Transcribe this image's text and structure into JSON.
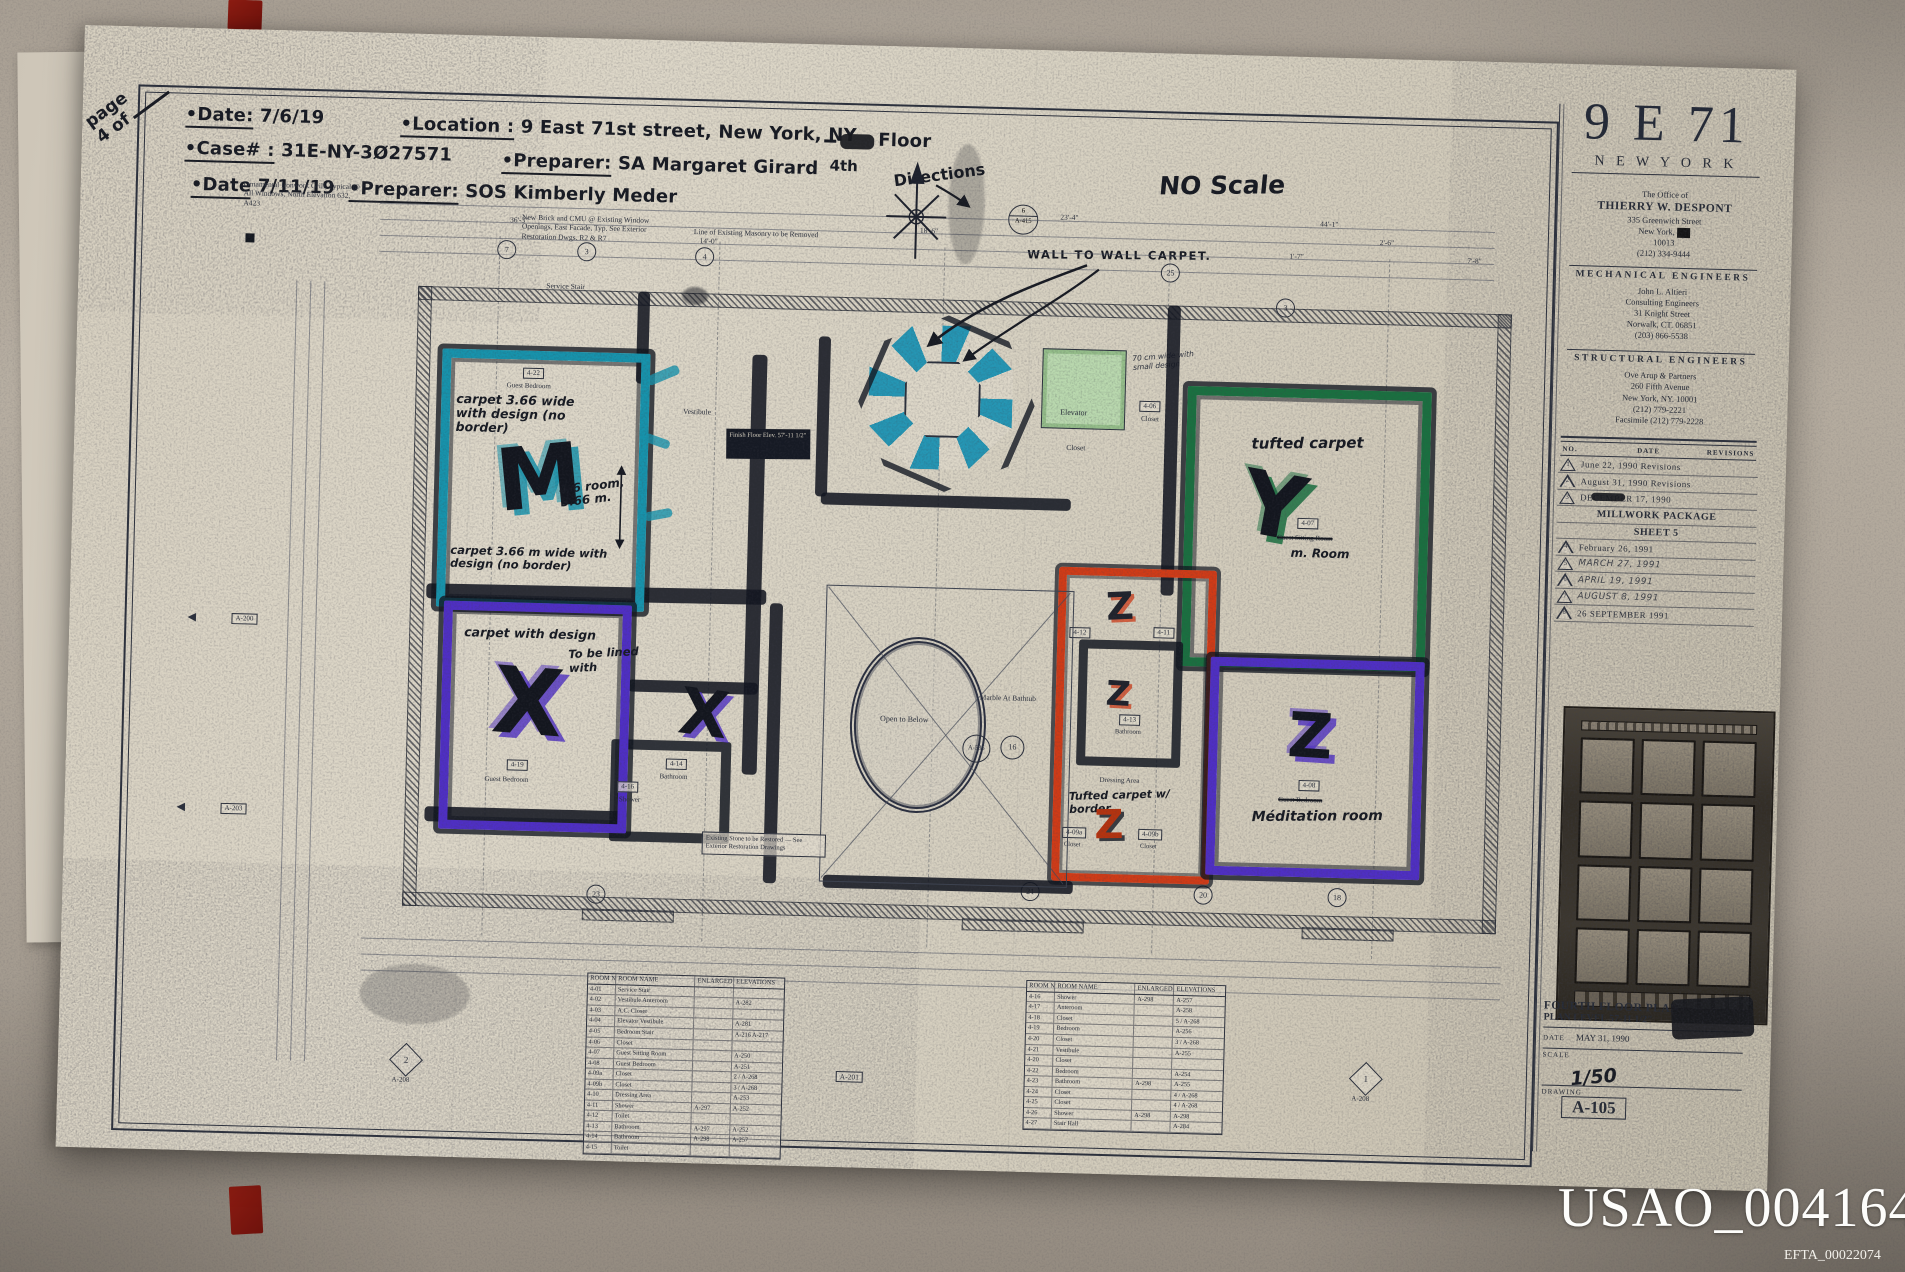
{
  "overlay": {
    "usao": "USAO_004164",
    "efta": "EFTA_00022074"
  },
  "handwritten": {
    "page_word": "page",
    "page_num": "4 of",
    "date1_label": "•Date:",
    "date1": "7/6/19",
    "location_label": "•Location :",
    "location": "9 East 71st street, New York, NY",
    "floor_word": "Floor",
    "floor_sub": "4th",
    "case_label": "•Case# :",
    "case_number": "31E-NY-3Ø27571",
    "preparer1_label": "•Preparer:",
    "preparer1": "SA Margaret Girard",
    "date2_label": "•Date",
    "date2": "7/11/19",
    "preparer2_label": "•Preparer:",
    "preparer2": "SOS Kimberly Meder",
    "directions": "Directions",
    "no_scale": "NO Scale",
    "wall_to_wall": "WALL TO WALL CARPET."
  },
  "plan": {
    "notes": {
      "ornamental": "Ornamental Ironwork Grill, Typical @ All Windows, North Elevation 632, A423",
      "brick": "New Brick and CMU @ Existing Window Openings, East Facade, Typ. See Exterior Restoration Dwgs. R2 & R7",
      "masonry": "Line of Existing Masonry to be Removed",
      "restore": "Existing Stone to be Restored — See Exterior Restoration Drawings",
      "finish_floor": "Finish Floor Elev. 57'-11 1/2\"",
      "seventy_cm": "70 cm wide with small design",
      "to_be_lined": "To be lined with",
      "marble": "Marble At Bathtub",
      "open_below": "Open to Below",
      "service_stair": "Service Stair",
      "vestibule": "Vestibule"
    },
    "rooms": {
      "cyan": {
        "tag": "4-22",
        "name": "Guest Bedroom",
        "letter": "M",
        "note_top": "carpet 3.66 wide with design (no border)",
        "note_mid": "4-6 room, 3.66 m.",
        "note_bottom": "carpet 3.66 m wide with design (no border)"
      },
      "purple": {
        "tag": "4-19",
        "name": "Guest Bedroom",
        "letter": "X",
        "note": "carpet with design"
      },
      "bath": {
        "tag": "4-14",
        "name": "Bathroom",
        "letter": "X"
      },
      "shower": {
        "tag": "4-16",
        "name": "Shower"
      },
      "green": {
        "tag": "4-07",
        "name": "Guest Sitting Room",
        "new_name": "m. Room",
        "letter": "Y",
        "note": "tufted carpet"
      },
      "meditation": {
        "tag": "4-08",
        "name": "Guest Bedroom",
        "new_name": "Méditation room",
        "letter": "Z"
      },
      "red_top": {
        "tag_left": "4-12",
        "tag_right": "4-11",
        "letter": "Z"
      },
      "red_mid": {
        "tag": "4-13",
        "name": "Bathroom",
        "letter": "Z"
      },
      "dressing": {
        "name": "Dressing Area",
        "note": "Tufted carpet w/ border",
        "letter": "Z",
        "closet_a": "4-09a",
        "closet_a_name": "Closet",
        "closet_b": "4-09b",
        "closet_b_name": "Closet"
      },
      "elevator": {
        "name": "Elevator",
        "closet": "Closet",
        "closet_tag": "4-06"
      }
    },
    "tags": {
      "a415_no": "6",
      "a415": "A-415",
      "a535": "A-535",
      "c16": "16",
      "a201": "A-201",
      "d2": "2",
      "d2_ref": "A-208",
      "d1": "1",
      "d1_ref": "A-208",
      "a200": "A-200",
      "a203": "A-203"
    },
    "bubbles": [
      "7",
      "3",
      "4",
      "25",
      "3",
      "23",
      "21",
      "20",
      "18"
    ],
    "dims": [
      "44'-1\"",
      "18'-6\"",
      "14'-0\"",
      "2'-6\"",
      "1'-7\"",
      "7'-8\"",
      "36'-3\"",
      "23'-4\""
    ]
  },
  "tables": {
    "headers": [
      "ROOM NO.",
      "ROOM NAME",
      "ENLARGED PLAN",
      "ELEVATIONS"
    ],
    "left": [
      [
        "4-01",
        "Service Stair",
        "",
        ""
      ],
      [
        "4-02",
        "Vestibule Anteroom",
        "",
        "A-282"
      ],
      [
        "4-03",
        "A.C. Closet",
        "",
        ""
      ],
      [
        "4-04",
        "Elevator Vestibule",
        "",
        "A-281"
      ],
      [
        "4-05",
        "Bedroom Stair",
        "",
        "A-216  A-217"
      ],
      [
        "4-06",
        "Closet",
        "",
        ""
      ],
      [
        "4-07",
        "Guest Sitting Room",
        "",
        "A-250"
      ],
      [
        "4-08",
        "Guest Bedroom",
        "",
        "A-251"
      ],
      [
        "4-09a",
        "Closet",
        "",
        "2 / A-268"
      ],
      [
        "4-09b",
        "Closet",
        "",
        "3 / A-268"
      ],
      [
        "4-10",
        "Dressing Area",
        "",
        "A-253"
      ],
      [
        "4-11",
        "Shower",
        "A-297",
        "A-252"
      ],
      [
        "4-12",
        "Toilet",
        "",
        ""
      ],
      [
        "4-13",
        "Bathroom",
        "A-297",
        "A-252"
      ],
      [
        "4-14",
        "Bathroom",
        "A-298",
        "A-257"
      ],
      [
        "4-15",
        "Toilet",
        "",
        ""
      ]
    ],
    "right": [
      [
        "4-16",
        "Shower",
        "A-298",
        "A-257"
      ],
      [
        "4-17",
        "Anteroom",
        "",
        "A-258"
      ],
      [
        "4-18",
        "Closet",
        "",
        "5 / A-268"
      ],
      [
        "4-19",
        "Bedroom",
        "",
        "A-256"
      ],
      [
        "4-20",
        "Closet",
        "",
        "3 / A-268"
      ],
      [
        "4-21",
        "Vestibule",
        "",
        "A-255"
      ],
      [
        "4-20",
        "Closet",
        "",
        ""
      ],
      [
        "4-22",
        "Bedroom",
        "",
        "A-254"
      ],
      [
        "4-23",
        "Bathroom",
        "A-298",
        "A-255"
      ],
      [
        "4-24",
        "Closet",
        "",
        "4 / A-268"
      ],
      [
        "4-25",
        "Closet",
        "",
        "4 / A-268"
      ],
      [
        "4-26",
        "Shower",
        "A-298",
        "A-298"
      ],
      [
        "4-27",
        "Stair Hall",
        "",
        "A-284"
      ]
    ]
  },
  "titleblock": {
    "big": "9 E 71",
    "city": "N E W   Y O R K",
    "office": [
      "The Office of",
      "THIERRY W. DESPONT",
      "335 Greenwich Street",
      "New York,",
      "10013",
      "(212) 334-9444"
    ],
    "mech_header": "MECHANICAL ENGINEERS",
    "mech": [
      "John L. Altieri",
      "Consulting Engineers",
      "31 Knight Street",
      "Norwalk, CT. 06851",
      "(203) 866-5538"
    ],
    "struct_header": "STRUCTURAL ENGINEERS",
    "struct": [
      "Ove Arup & Partners",
      "260 Fifth Avenue",
      "New York, NY. 10001",
      "(212) 779-2221",
      "Facsimile (212) 779-2228"
    ],
    "rev_headers": [
      "NO.",
      "DATE",
      "REVISIONS"
    ],
    "revisions": [
      {
        "no": "1",
        "text": "June 22, 1990 Revisions"
      },
      {
        "no": "2",
        "text": "August 31, 1990 Revisions"
      },
      {
        "no": "3",
        "text": "DECEMBER 17, 1990",
        "scribble": true
      },
      {
        "no": "",
        "text": "MILLWORK PACKAGE"
      },
      {
        "no": "",
        "text": "SHEET 5"
      },
      {
        "no": "4",
        "text": "February 26, 1991"
      },
      {
        "no": "5",
        "text": "MARCH 27, 1991",
        "hand": true
      },
      {
        "no": "6",
        "text": "APRIL 19, 1991",
        "hand": true
      },
      {
        "no": "7",
        "text": "AUGUST 8, 1991",
        "hand": true
      },
      {
        "no": "8",
        "text": "26 SEPTEMBER 1991"
      }
    ],
    "sheet_title1": "FOURTH FLOOR PLAN",
    "sheet_title2": "PLAN LEVEL 57-11 1/2\"",
    "date_label": "DATE",
    "date": "MAY 31, 1990",
    "scale_label": "SCALE",
    "scale": "1/50",
    "drawing_label": "DRAWING",
    "drawing": "A-105"
  },
  "colors": {
    "teal": "#1793ac",
    "purple": "#4f2fc4",
    "green": "#1a7040",
    "red": "#d03b17",
    "marker": "#14181f",
    "ink": "#2c313d",
    "elevator_green": "#b9d8ae"
  }
}
